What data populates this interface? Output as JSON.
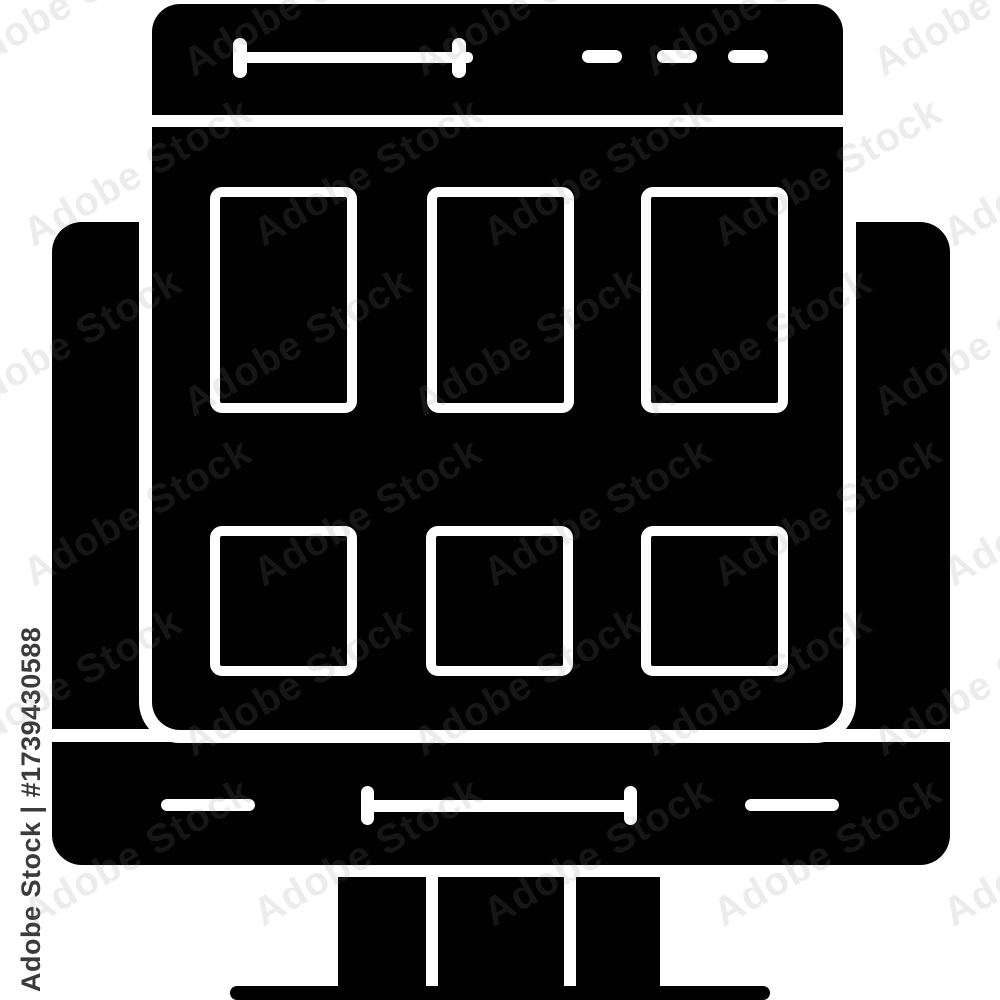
{
  "watermark": {
    "brand": "Adobe Stock",
    "asset_id": "#1739430588",
    "side_label": "Adobe Stock | #1739430588",
    "tile_text": "Adobe Stock"
  },
  "icon": {
    "name": "web-layout-browser-on-monitor-glyph",
    "description": "Black glyph icon: browser window with address bar, three menu dashes, grid of three tall panels and three square panels, shown on a desktop monitor with stand and base",
    "colors": {
      "glyph": "#010101",
      "background": "#ffffff",
      "cutout": "#ffffff",
      "side_watermark_text": "#3b3b3b"
    }
  }
}
